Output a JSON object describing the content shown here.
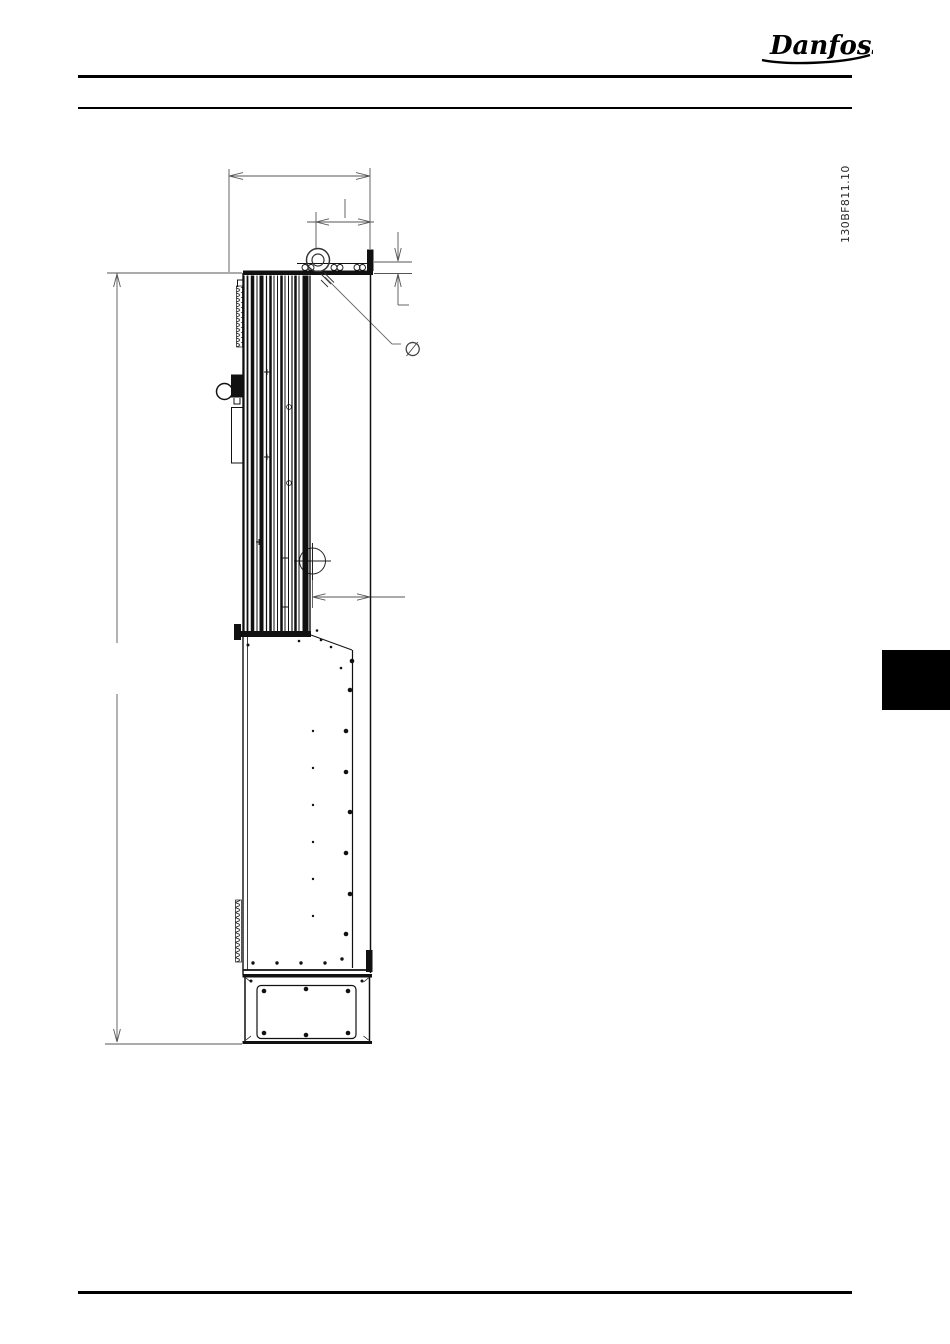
{
  "header": {
    "logo_text": "Danfoss"
  },
  "figure": {
    "id_label": "130BF811.10",
    "diameter_symbol": "∅",
    "description_name": "drive-enclosure-side-view"
  },
  "colors": {
    "ink": "#111111",
    "dimension_line": "#555555",
    "section_tab": "#000000",
    "page_background": "#ffffff"
  }
}
